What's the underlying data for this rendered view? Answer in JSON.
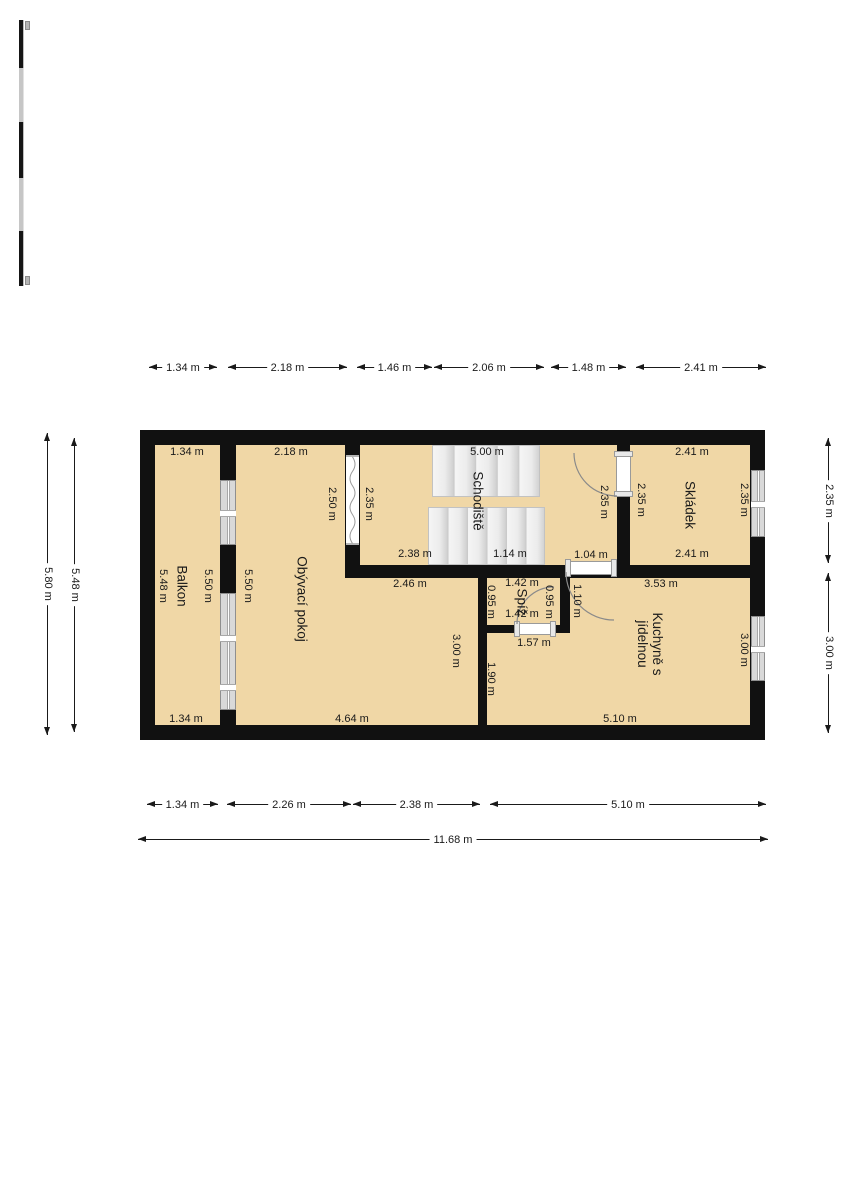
{
  "colors": {
    "floor": "#f0d7a6",
    "wall": "#111111",
    "window_glass": "#d9d9d9",
    "dimension_line": "#1a1a1a"
  },
  "rooms": {
    "balkon": {
      "label": "Balkon",
      "dim_top": "1.34 m",
      "dim_left": "5.48 m",
      "dim_right": "5.50 m",
      "dim_bottom": "1.34 m"
    },
    "obyvaci_pokoj": {
      "label": "Obývací pokoj",
      "dim_top": "2.18 m",
      "dim_left": "5.50 m",
      "dim_right_upper": "2.50 m",
      "dim_upper_right": "2.46 m",
      "dim_right_lower": "3.00 m",
      "dim_bottom": "4.64 m"
    },
    "schodiste": {
      "label": "Schodiště",
      "dim_top": "5.00 m",
      "dim_left": "2.35 m",
      "dim_bottom_left": "2.38 m",
      "dim_bottom_mid": "1.14 m",
      "dim_door": "1.04 m",
      "dim_right": "2.35 m"
    },
    "skladek": {
      "label": "Skládek",
      "dim_top": "2.41 m",
      "dim_left": "2.35 m",
      "dim_right": "2.35 m",
      "dim_bottom": "2.41 m"
    },
    "spiz": {
      "label": "Spíž",
      "dim_top": "1.42 m",
      "dim_left": "0.95 m",
      "dim_right": "0.95 m",
      "dim_bottom": "1.42 m",
      "dim_below": "1.57 m",
      "dim_door": "1.10 m"
    },
    "kuchyne": {
      "label_line1": "Kuchyně s",
      "label_line2": "jídelnou",
      "dim_top": "3.53 m",
      "dim_left": "1.90 m",
      "dim_right": "3.00 m",
      "dim_bottom": "5.10 m"
    }
  },
  "dimensions": {
    "top": [
      "1.34 m",
      "2.18 m",
      "1.46 m",
      "2.06 m",
      "1.48 m",
      "2.41 m"
    ],
    "bottom": [
      "1.34 m",
      "2.26 m",
      "2.38 m",
      "5.10 m"
    ],
    "bottom_total": "11.68 m",
    "left": [
      "5.80 m",
      "5.48 m"
    ],
    "right": [
      "2.35 m",
      "3.00 m"
    ]
  }
}
